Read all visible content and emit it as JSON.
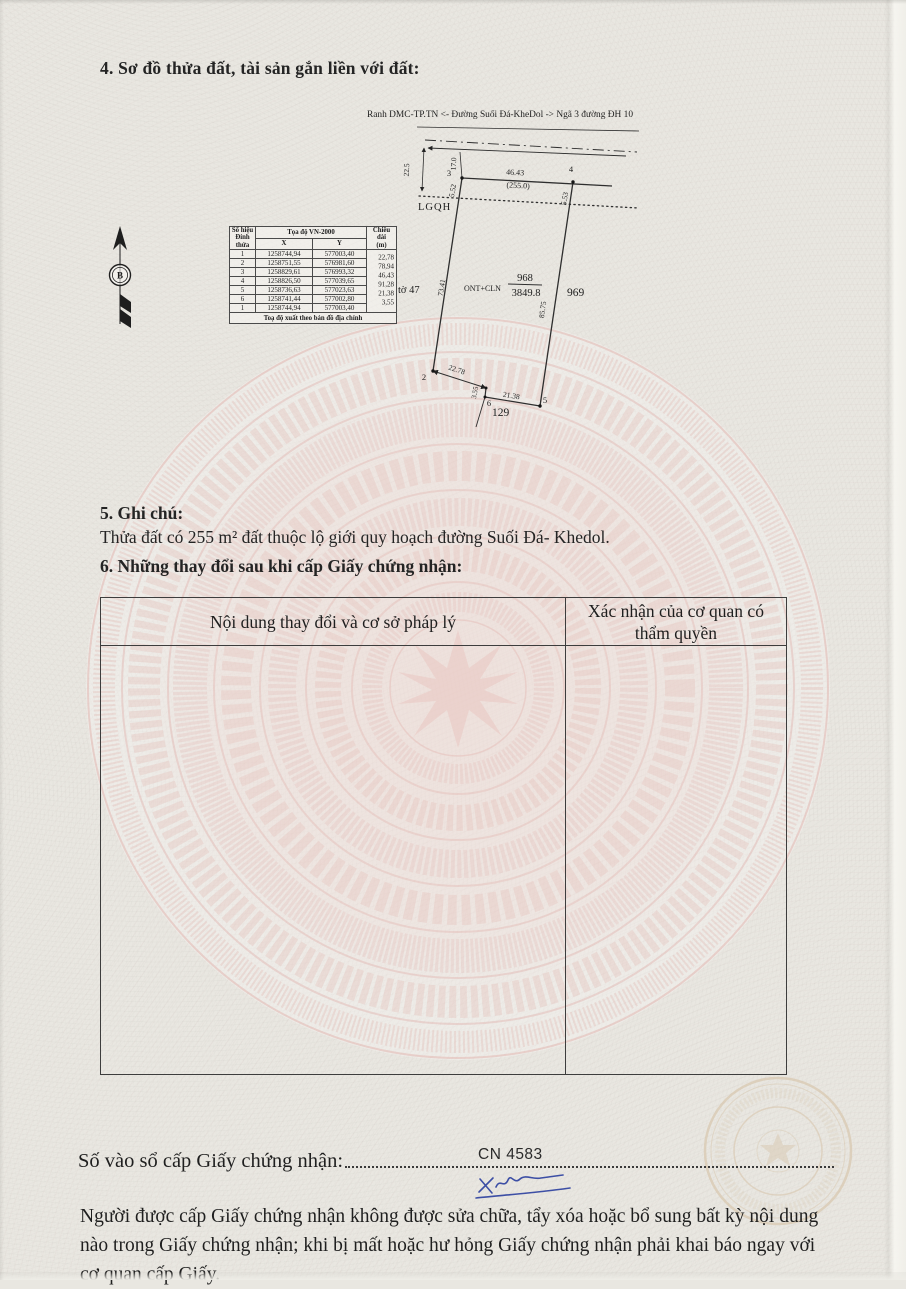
{
  "document": {
    "section4_title": "4. Sơ đồ thửa đất, tài sản gắn liền với đất:",
    "section5_title": "5. Ghi chú:",
    "section5_note": "Thửa đất có 255 m² đất thuộc lộ giới quy hoạch đường Suối Đá- Khedol.",
    "section6_title": "6. Những thay đổi sau khi cấp Giấy chứng nhận:",
    "registry_label": "Số vào sổ cấp Giấy chứng nhận:",
    "registry_number": "CN 4583",
    "footer_note": "Người được cấp Giấy chứng nhận không được sửa chữa, tẩy xóa hoặc bổ sung bất kỳ nội dung nào trong Giấy chứng nhận; khi bị mất hoặc hư hỏng Giấy chứng nhận phải khai báo ngay với cơ quan cấp Giấy."
  },
  "diagram": {
    "road_label": "Ranh DMC-TP.TN <- Đường Suối Đá-KheDol -> Ngã 3 đường ĐH 10",
    "north_label": "B",
    "lgqh_label": "LGQH",
    "sheet_label": "tờ 47",
    "land_use_label": "ONT+CLN",
    "parcel_number": "968",
    "parcel_area": "3849.8",
    "neighbor_parcel_right": "969",
    "neighbor_parcel_bottom": "129",
    "dims": {
      "top_edge": "46.43",
      "road_corridor_area": "(255.0)",
      "left_edge_lower": "73.41",
      "right_edge_lower": "85.75",
      "bottom_edge_1": "22.78",
      "bottom_edge_2": "3.55",
      "bottom_edge_3": "21.38",
      "road_offset_left": "22.5",
      "road_offset_v3": "17.0",
      "lgqh_offset_left": "5.52",
      "lgqh_offset_right": "5.53"
    },
    "vertices": {
      "v2": "2",
      "v3": "3",
      "v4": "4",
      "v5": "5",
      "v6": "6"
    }
  },
  "coord_table": {
    "header_col1_line1": "Số hiệu",
    "header_col1_line2": "Đỉnh thửa",
    "header_coords": "Tọa độ VN-2000",
    "header_x": "X",
    "header_y": "Y",
    "header_length_line1": "Chiều dài",
    "header_length_line2": "(m)",
    "rows": [
      {
        "v": "1",
        "x": "1258744,94",
        "y": "577003,40"
      },
      {
        "v": "2",
        "x": "1258751,55",
        "y": "576981,60"
      },
      {
        "v": "3",
        "x": "1258829,61",
        "y": "576993,32"
      },
      {
        "v": "4",
        "x": "1258826,50",
        "y": "577039,65"
      },
      {
        "v": "5",
        "x": "1258736,63",
        "y": "577023,63"
      },
      {
        "v": "6",
        "x": "1258741,44",
        "y": "577002,80"
      },
      {
        "v": "1",
        "x": "1258744,94",
        "y": "577003,40"
      }
    ],
    "lengths": [
      "22,78",
      "78,94",
      "46,43",
      "91,28",
      "21,38",
      "3,55"
    ],
    "footer": "Toạ độ xuất theo bản đồ địa chính"
  },
  "changes_table": {
    "col1_header": "Nội dung thay đổi và cơ sở pháp lý",
    "col2_header": "Xác nhận của cơ quan có thẩm quyền"
  }
}
